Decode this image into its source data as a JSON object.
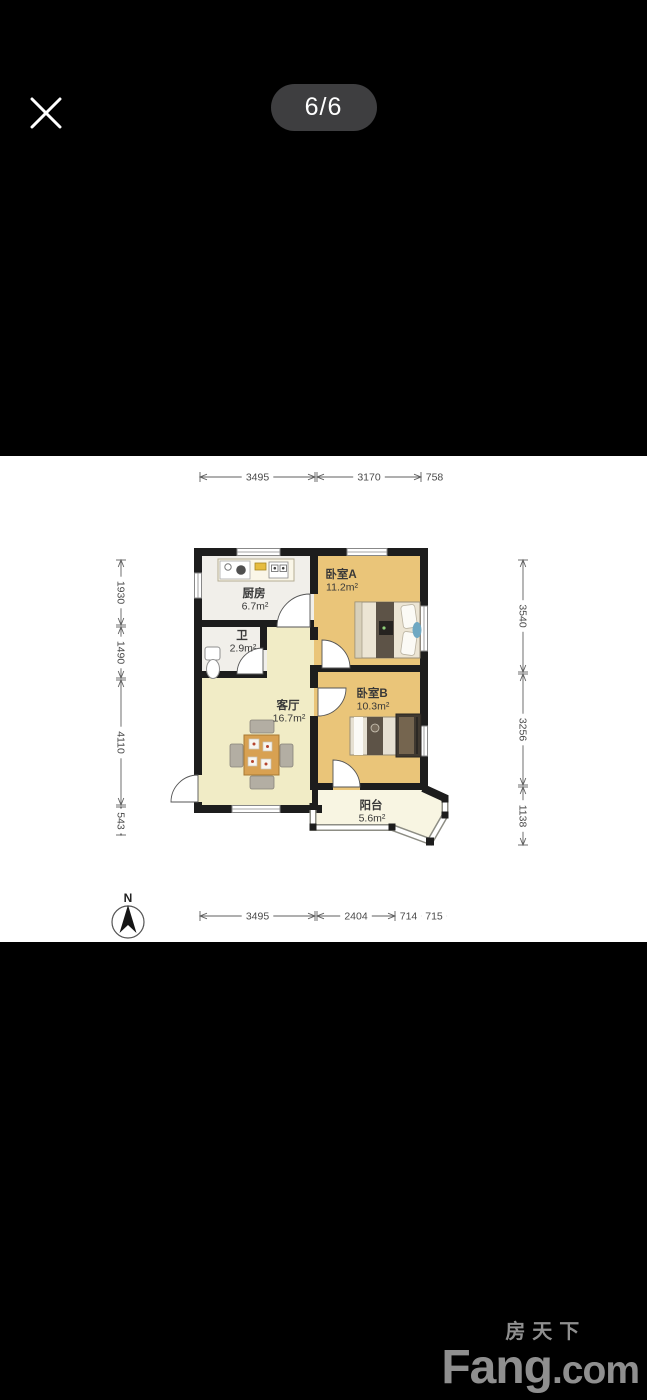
{
  "viewer": {
    "counter": "6/6"
  },
  "floorplan": {
    "rooms": [
      {
        "id": "kitchen",
        "name": "厨房",
        "area": "6.7m²"
      },
      {
        "id": "bath",
        "name": "卫",
        "area": "2.9m²"
      },
      {
        "id": "living",
        "name": "客厅",
        "area": "16.7m²"
      },
      {
        "id": "bedroomA",
        "name": "卧室A",
        "area": "11.2m²"
      },
      {
        "id": "bedroomB",
        "name": "卧室B",
        "area": "10.3m²"
      },
      {
        "id": "balcony",
        "name": "阳台",
        "area": "5.6m²"
      }
    ],
    "dimensions_mm": {
      "top": [
        "3495",
        "3170",
        "758"
      ],
      "bottom": [
        "3495",
        "2404",
        "714",
        "715"
      ],
      "left": [
        "1930",
        "1490",
        "4110",
        "543"
      ],
      "right": [
        "3540",
        "3256",
        "1138"
      ]
    },
    "compass_label": "N",
    "colors": {
      "wall": "#1d1d1d",
      "bedroom": "#eac579",
      "living": "#f1ecc6",
      "balcony": "#f8f5e2",
      "kitchen_bath": "#f1efea"
    }
  },
  "watermark": {
    "cn": "房天下",
    "en_main": "Fang",
    "en_suffix": ".com"
  }
}
